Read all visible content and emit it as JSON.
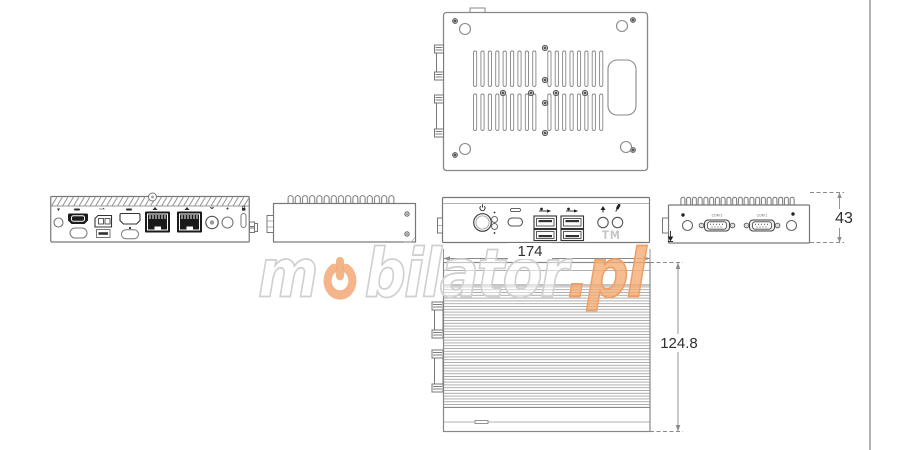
{
  "dimensions": {
    "width": "174",
    "height": "124.8",
    "depth": "43"
  },
  "port_labels": {
    "com_left": "COM 2",
    "com_right": "COM 1"
  },
  "watermark": {
    "pre": "m",
    "post": "bilator",
    "tld": ".pl",
    "tm": "TM",
    "orange": "#f2ad7c",
    "outline_gray": "#d0d0d0"
  },
  "colors": {
    "line": "#7d7d7d",
    "dark_port": "#1d1d1d",
    "dimension_text": "#2f2f2f",
    "divider": "#b3b3b3"
  },
  "icons": {
    "power-icon": "⏻",
    "hdmi-icon": "▭",
    "displayport-icon": "▭",
    "lan-icon": "⌸",
    "usb-icon": "⑂",
    "usb-c-icon": "▭",
    "audio-out-icon": "▲",
    "mic-icon": "◌",
    "lock-icon": "▣",
    "antenna-icon": "○",
    "ground-icon": "⏚"
  }
}
